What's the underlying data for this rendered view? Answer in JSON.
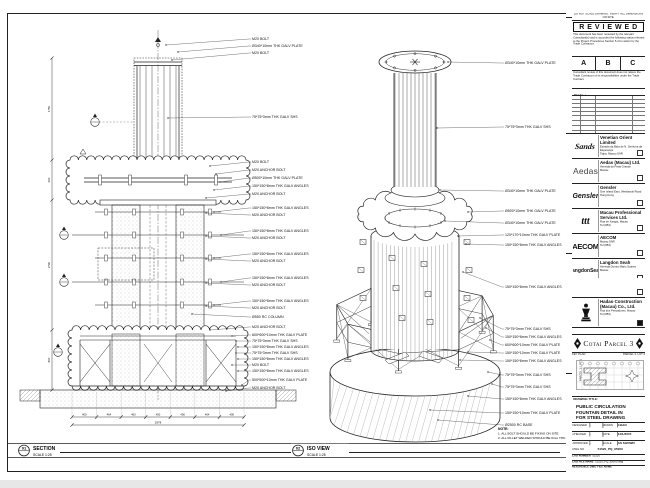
{
  "sheet": {
    "strip_note": "DO NOT SCALE DRAWING. VERIFY ALL DIMENSIONS ON SITE.",
    "project_title_label": "PROJECT TITLE",
    "project_title": "Cotai Parcel 3"
  },
  "stamp": {
    "title": "R E V I E W E D",
    "para1": "This document has been reviewed by the relevant Consultant(s) and is accorded the following status relevant to the Project Procedures Section 5.4 for action by the Trade Contractor.",
    "options": [
      "A",
      "B",
      "C"
    ],
    "para2": "Consultant review of this document does not relieve the Trade Contractor of its responsibilities under the Trade Contract.",
    "date_label": "Date :"
  },
  "revisions": {
    "headers": [
      "REV",
      "DATE",
      "DESCRIPTION",
      "BY"
    ],
    "rows": [
      [
        "C",
        "11/03/15",
        "FOR APPROVAL",
        "WN"
      ],
      [
        "B",
        "06/02/15",
        "FOR APPROVAL",
        "WN"
      ],
      [
        "A",
        "14/01/15",
        "FOR APPROVAL",
        "WN"
      ]
    ]
  },
  "companies": [
    {
      "logo": "Sands",
      "name": "Venetian Orient Limited",
      "line1": "Estrada da Baía de N. Senhora da Esperança",
      "line2": "Taipa, Macau SAR"
    },
    {
      "logo": "Aedas",
      "name": "Aedas (Macau) Ltd.",
      "line1": "Avenida da Praia Grande",
      "line2": "Macau"
    },
    {
      "logo": "Gensler",
      "name": "Gensler",
      "line1": "One Island East, Westlands Road",
      "line2": "Hong Kong"
    },
    {
      "logo": "ttt",
      "name": "Macau Professional Services Ltd.",
      "line1": "Rua de Xangai, Macau",
      "line2": "Tel (853)"
    },
    {
      "logo": "AECOM",
      "name": "AECOM",
      "line1": "Macau SAR",
      "line2": "Tel (853)"
    },
    {
      "logo": "LangdonSeah",
      "name": "Langdon Seah",
      "line1": "Avenida Doutor Mário Soares",
      "line2": "Macau"
    }
  ],
  "contractor": {
    "name": "Hadao Construction (Macau) Co., Ltd.",
    "line1": "Rua dos Pescadores, Macau",
    "line2": "Tel (853)"
  },
  "key_plan": {
    "label": "KEY PLAN",
    "top_right": "PARCEL 3, LOT 2",
    "left": "PARCEL 1, LOT 1",
    "bottom": "PARCEL 3, LOT 2"
  },
  "drawing_title": {
    "label": "DRAWING TITLE:",
    "lines": [
      "PUBLIC CIRCULATION",
      "FOUNTAIN DETAIL IN",
      "FOR STEEL DRAWING"
    ]
  },
  "fields": {
    "rows": [
      {
        "k1": "DESIGNED",
        "v1": "-",
        "k2": "DRAWN",
        "v2": "CHAO"
      },
      {
        "k1": "CHECKED",
        "v1": "-",
        "k2": "DATE",
        "v2": "14/1/2015"
      },
      {
        "k1": "APPROVED",
        "v1": "-",
        "k2": "SCALE",
        "v2": "AS SHOWN"
      }
    ],
    "dwg_label": "DWG NO",
    "dwg_no": "51520_PQ_95000",
    "rev_label": "REV",
    "rev": "C",
    "cad_no_label": "CAD NUMBER",
    "cad_no": "51520",
    "cad_file_label": "CAD FILE NAME",
    "cad_file": "51520_PQ_95000.dwg",
    "ref_label": "REFERENCE DWG FILE NAME"
  },
  "views": {
    "section": {
      "num": "01",
      "name": "SECTION",
      "scale": "SCALE 1:25",
      "labels": [
        "M20 BOLT",
        "Ø340*10mm THK GALV PLATE",
        "M20 BOLT",
        "75*75*3mm THK GALV SHS",
        "M20 BOLT",
        "M20 ANCHOR BOLT",
        "Ø500*10mm THK GALV PLATE",
        "150*150*8mm THK GALV ANGLES",
        "M20 ANCHOR BOLT",
        "150*150*8mm THK GALV ANGLES",
        "M20 ANCHOR BOLT",
        "150*150*8mm THK GALV ANGLES",
        "M20 ANCHOR BOLT",
        "150*150*8mm THK GALV ANGLES",
        "M20 ANCHOR BOLT",
        "150*150*8mm THK GALV ANGLES",
        "M20 ANCHOR BOLT",
        "150*150*8mm THK GALV ANGLES",
        "M20 ANCHOR BOLT",
        "Ø550 RC COLUMN",
        "M20 ANCHOR BOLT",
        "600*600*10mm THK GALV PLATE",
        "75*75*3mm THK GALV SHS",
        "150*150*8mm THK GALV ANGLES",
        "75*75*3mm THK GALV SHS",
        "150*150*8mm THK GALV ANGLES",
        "M20 BOLT",
        "150*150*8mm THK GALV ANGLES",
        "500*500*10mm THK GALV PLATE",
        "M20 ANCHOR BOLT"
      ],
      "dims_bottom": [
        "400",
        "464",
        "400",
        "450",
        "400",
        "464",
        "400"
      ],
      "dim_total": "2978",
      "dims_left": [
        "1750",
        "600",
        "2700",
        "800"
      ]
    },
    "iso": {
      "num": "02",
      "name": "ISO VIEW",
      "scale": "SCALE 1:25",
      "labels": [
        "Ø340*10mm THK GALV PLATE",
        "75*75*3mm THK GALV SHS",
        "Ø340*10mm THK GALV PLATE",
        "Ø500*10mm THK GALV PLATE",
        "Ø340*10mm THK GALV PLATE",
        "120*170*10mm THK GALV PLATE",
        "150*150*8mm THK GALV ANGLES",
        "150*150*8mm THK GALV ANGLES",
        "75*75*3mm THK GALV SHS",
        "150*150*8mm THK GALV ANGLES",
        "600*600*10mm THK GALV PLATE",
        "150*150*10mm THK GALV PLATE",
        "150*150*8mm THK GALV ANGLES",
        "75*75*3mm THK GALV SHS",
        "75*75*3mm THK GALV SHS",
        "150*150*8mm THK GALV ANGLES",
        "150*150*10mm THK GALV PLATE",
        "Ø2500 RC BASE"
      ]
    }
  },
  "notes": {
    "title": "NOTE:",
    "items": [
      "1. ALL BOLT SHOULD BE FIXING ON SITE.",
      "2. ALL FILLET WELDED SHOULD BE 6mm THK."
    ]
  }
}
